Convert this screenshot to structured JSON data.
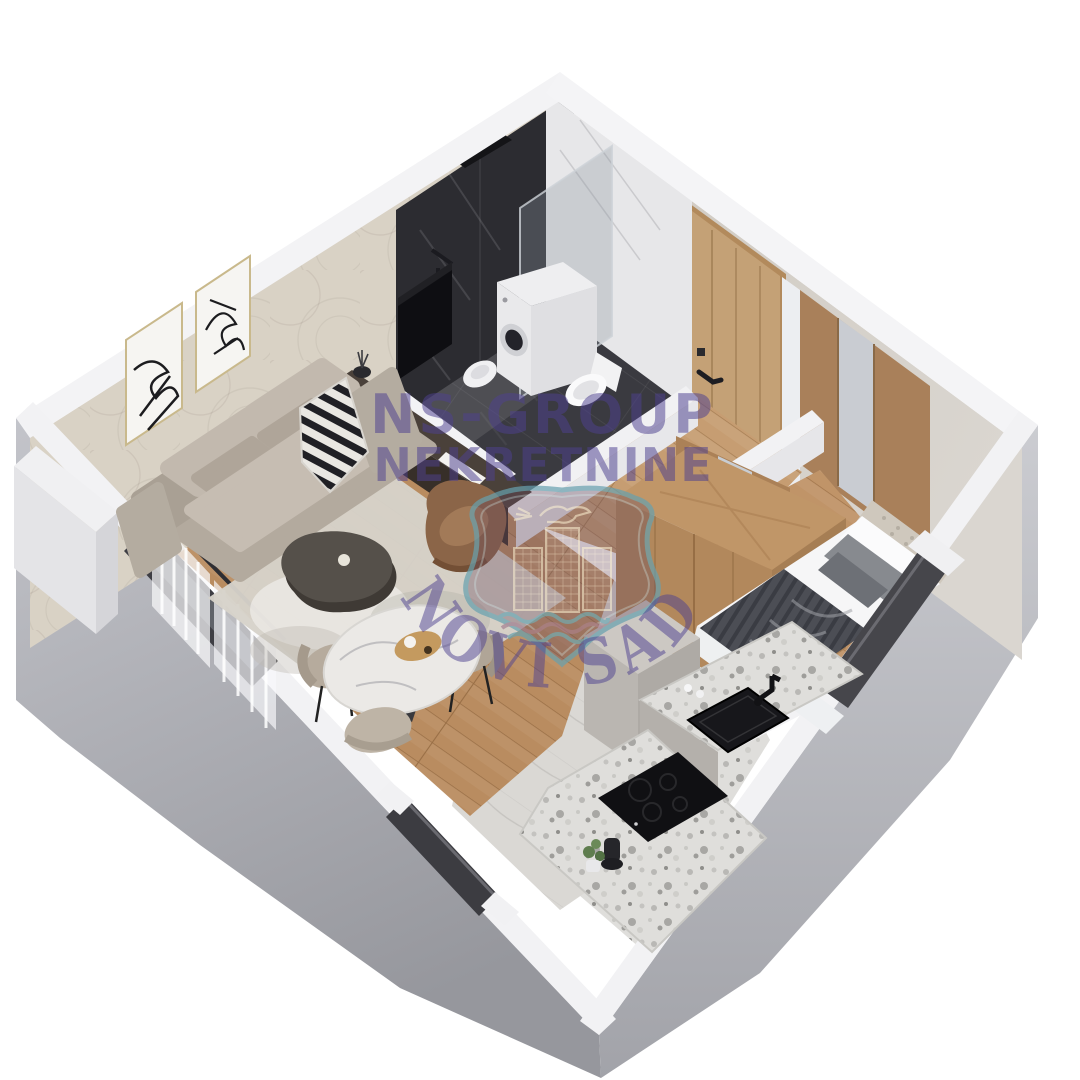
{
  "image_type": "3d-isometric-floor-plan-render",
  "watermark": {
    "brand_line1": "NS-GROUP",
    "brand_line2": "NEKRETNINE",
    "city_arc_text": "NOVI SAD",
    "text_color": "#4e4190",
    "shield": {
      "border_color": "#67a1af",
      "fill_color": "rgba(104,72,94,0.5)",
      "motifs": [
        "dove-and-branch",
        "three-towers",
        "river-waves"
      ]
    }
  },
  "scene": {
    "background_color": "#ffffff",
    "rooms": [
      {
        "name": "bathroom",
        "features": [
          "black-marble-shower-wall",
          "glass-partition",
          "rain-shower-head",
          "washing-machine",
          "toilet",
          "bidet",
          "white-marble-wall",
          "dark-tile-floor"
        ]
      },
      {
        "name": "hallway",
        "features": [
          "entrance-door",
          "mirror-wardrobe",
          "wood-floor"
        ]
      },
      {
        "name": "living-room",
        "features": [
          "sofa",
          "zebra-throw",
          "coffee-table",
          "armchair",
          "area-rug",
          "tv",
          "tv-console",
          "two-wall-art-frames",
          "sheer-curtains",
          "balcony-window"
        ]
      },
      {
        "name": "dining-area",
        "features": [
          "round-marble-table",
          "wooden-tray",
          "two-chairs",
          "pouf"
        ]
      },
      {
        "name": "bedroom",
        "features": [
          "double-bed",
          "tufted-headboard",
          "gray-blanket",
          "large-wardrobe",
          "window"
        ]
      },
      {
        "name": "kitchen",
        "features": [
          "terrazzo-counter",
          "black-sink",
          "black-faucet",
          "black-cooktop",
          "tall-cabinet",
          "plant",
          "window"
        ]
      }
    ],
    "palette": {
      "wood_floor": "#b98c60",
      "wood_floor_light": "#c69d72",
      "wood_furniture": "#b2885c",
      "exterior_wall_dark": "#9a9ba1",
      "exterior_wall_light": "#c6c7cc",
      "wall_top": "#f3f3f5",
      "wallpaper": "#d9d2c5",
      "interior_wall": "#d2ccc4",
      "dark_marble": "#2c2c31",
      "white_marble": "#e7e7e9",
      "terrazzo": "#dfdedb",
      "dark_tile": "#3a3a40",
      "sofa_beige": "#b3aa9e",
      "blanket_gray": "#4c4e55",
      "appliance_black": "#141418"
    }
  }
}
